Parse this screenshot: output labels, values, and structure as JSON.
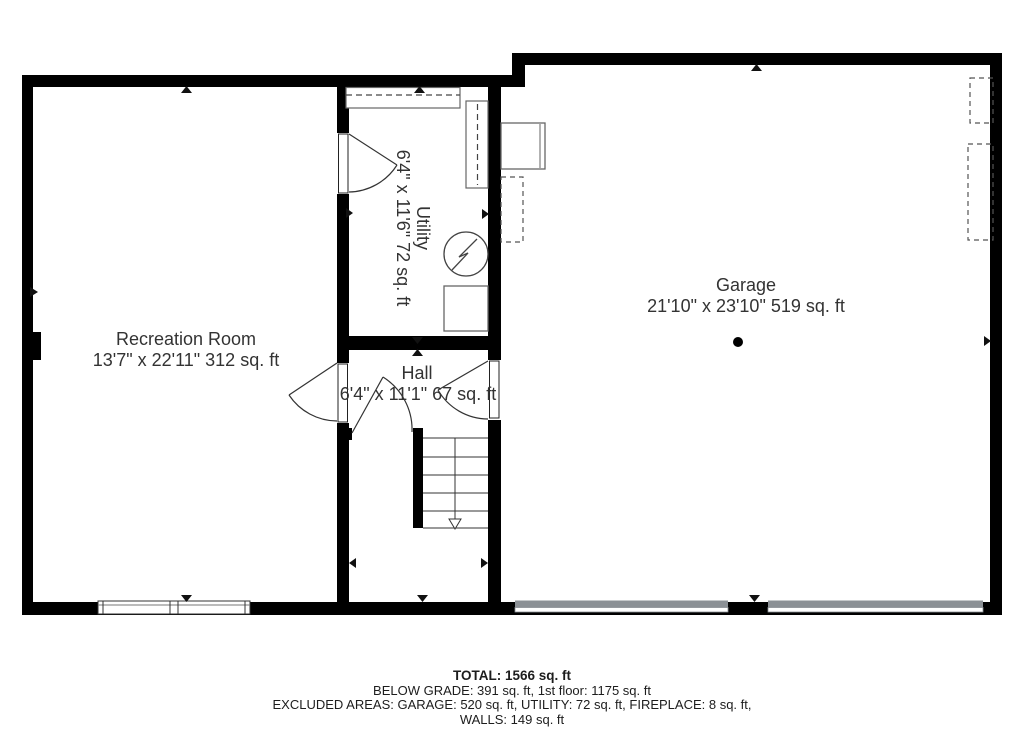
{
  "plan": {
    "rooms": {
      "recreation": {
        "name": "Recreation Room",
        "dims": "13'7\" x 22'11\" 312 sq. ft"
      },
      "utility": {
        "name": "Utility",
        "dims": "6'4\" x 11'6\" 72 sq. ft"
      },
      "hall": {
        "name": "Hall",
        "dims": "6'4\" x 11'1\" 67 sq. ft"
      },
      "garage": {
        "name": "Garage",
        "dims": "21'10\" x 23'10\" 519 sq. ft"
      }
    }
  },
  "footer": {
    "total": "TOTAL: 1566 sq. ft",
    "below_grade": "BELOW GRADE: 391 sq. ft, 1st floor: 1175 sq. ft",
    "excluded": "EXCLUDED AREAS: GARAGE: 520 sq. ft, UTILITY: 72 sq. ft, FIREPLACE: 8 sq. ft,",
    "walls": "WALLS: 149 sq. ft"
  },
  "colors": {
    "wall": "#000000",
    "label_text": "#333333",
    "footer_text": "#1d1d1d",
    "garage_door": "#8b9095",
    "fixture_line": "#666666"
  }
}
